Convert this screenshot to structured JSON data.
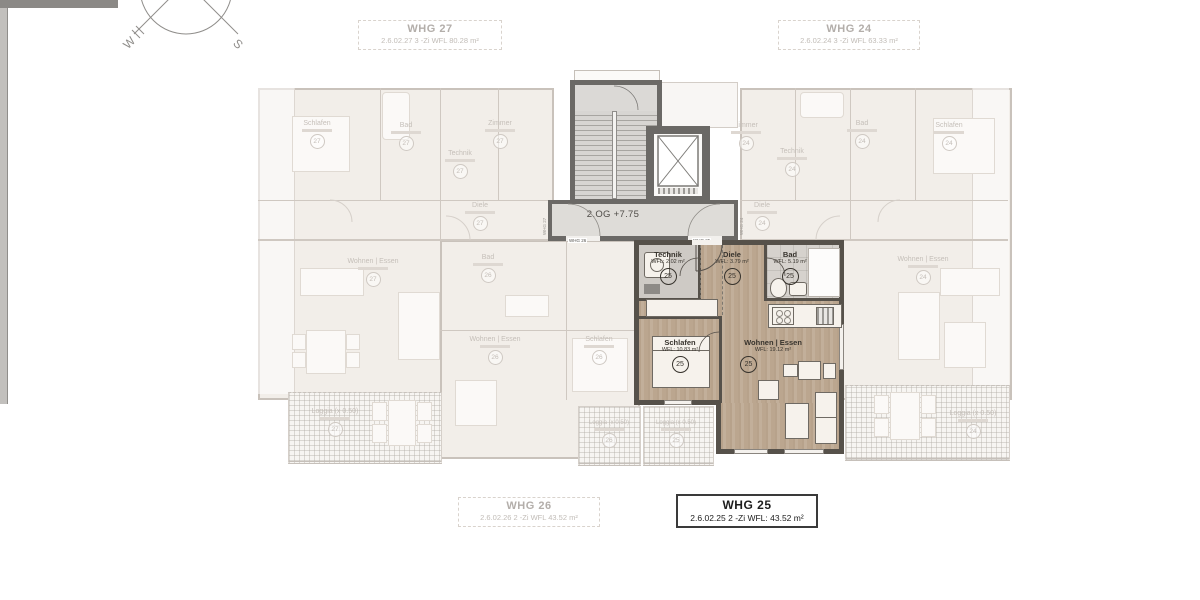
{
  "colors": {
    "highlight_floor": "#bca791",
    "highlight_wall": "#56514a",
    "faded_line": "#cfc8c1",
    "active_text": "#1c1c1c",
    "faded_text": "#c5bfb9"
  },
  "compass": {
    "west": "W",
    "south": "S"
  },
  "title_boxes": [
    {
      "name": "WHG 27",
      "details": "2.6.02.27    3 -Zi  WFL   80.28 m²",
      "state": "faded"
    },
    {
      "name": "WHG 24",
      "details": "2.6.02.24    3 -Zi  WFL   63.33 m²",
      "state": "faded"
    },
    {
      "name": "WHG 26",
      "details": "2.6.02.26    2 -Zi  WFL   43.52 m²",
      "state": "faded"
    },
    {
      "name": "WHG 25",
      "details": "2.6.02.25    2 -Zi  WFL:  43.52 m²",
      "state": "active"
    }
  ],
  "floor_label": "2.OG +7.75",
  "corridor_labels": {
    "left_unit": "WHG 27",
    "right_unit": "WHG 24",
    "door_left": "WHG 26",
    "door_right": "WHG 25"
  },
  "unit25": {
    "number": "25",
    "rooms": [
      {
        "name": "Technik",
        "area": "WFL: 2.02 m²",
        "nr": "25"
      },
      {
        "name": "Diele",
        "area": "WFL: 3.79 m²",
        "nr": "25"
      },
      {
        "name": "Bad",
        "area": "WFL: 5.19 m²",
        "nr": "25"
      },
      {
        "name": "Schlafen",
        "area": "WFL: 10.83 m²",
        "nr": "25"
      },
      {
        "name": "Wohnen | Essen",
        "area": "WFL: 19.12 m²",
        "nr": "25"
      }
    ]
  },
  "faded_rooms": [
    {
      "name": "Schlafen",
      "nr": "27"
    },
    {
      "name": "Bad",
      "nr": "27"
    },
    {
      "name": "Zimmer",
      "nr": "27"
    },
    {
      "name": "Technik",
      "nr": "27"
    },
    {
      "name": "Diele",
      "nr": "27"
    },
    {
      "name": "Wohnen | Essen",
      "nr": "27"
    },
    {
      "name": "Bad",
      "nr": "26"
    },
    {
      "name": "Wohnen | Essen",
      "nr": "26"
    },
    {
      "name": "Schlafen",
      "nr": "26"
    },
    {
      "name": "Zimmer",
      "nr": "24"
    },
    {
      "name": "Technik",
      "nr": "24"
    },
    {
      "name": "Bad",
      "nr": "24"
    },
    {
      "name": "Schlafen",
      "nr": "24"
    },
    {
      "name": "Diele",
      "nr": "24"
    },
    {
      "name": "Wohnen | Essen",
      "nr": "24"
    }
  ],
  "loggias": [
    {
      "label": "Loggia (x 0.50)",
      "nr": "27"
    },
    {
      "label": "Loggia (x 0.50)",
      "nr": "26"
    },
    {
      "label": "Loggia (x 0.50)",
      "nr": "25"
    },
    {
      "label": "Loggia (x 0.50)",
      "nr": "24"
    }
  ]
}
